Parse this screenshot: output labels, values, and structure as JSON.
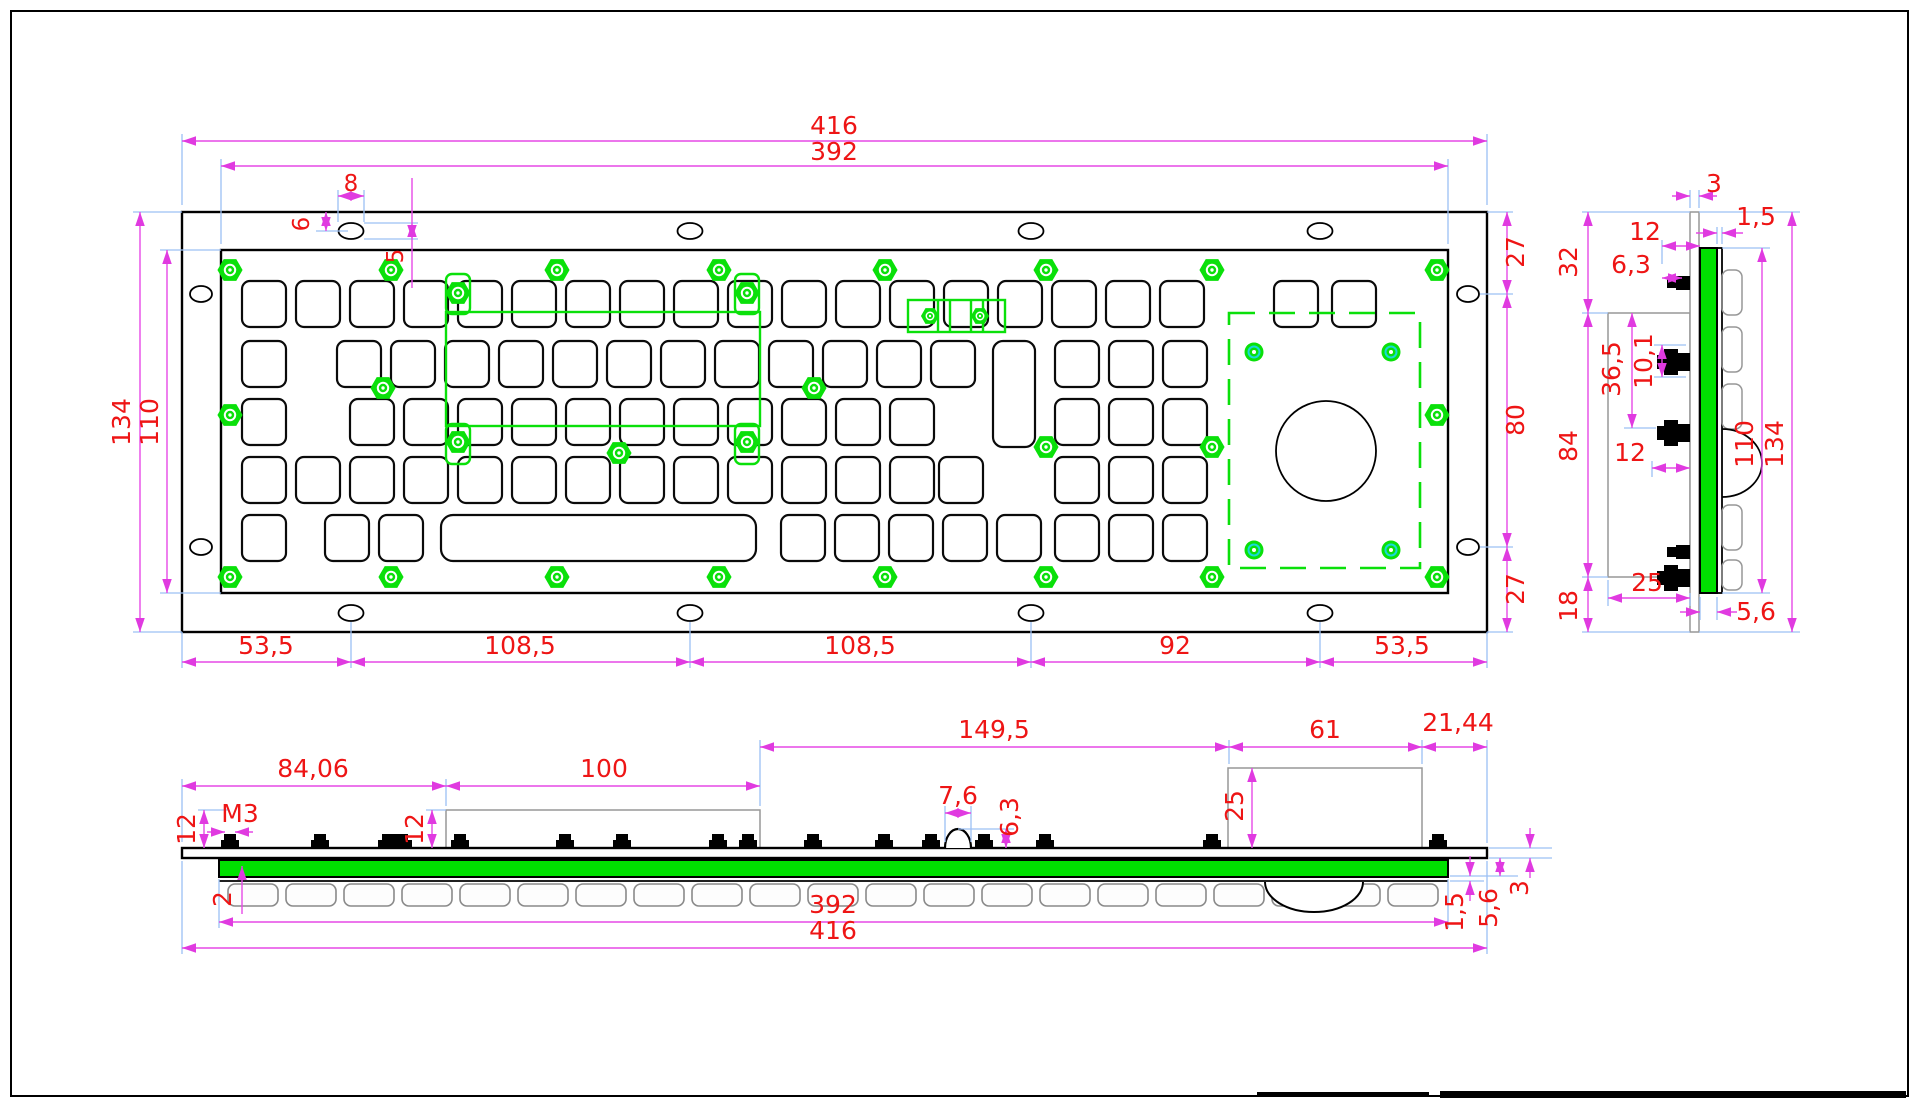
{
  "drawing": {
    "description": "CAD technical drawing of a panel-mount industrial metal keyboard with trackball: front view, side section view and bottom profile view with dimensions (mm)",
    "colors": {
      "dimension_text": "#ee1515",
      "dimension_line": "#e649e6",
      "extension_line": "#9cc0f4",
      "highlight_green": "#0ae00a",
      "panel_fill_green": "#00e000",
      "outline_black": "#000000",
      "outline_gray": "#979797"
    },
    "front": {
      "d416": "416",
      "d392": "392",
      "d8": "8",
      "d6": "6",
      "d5": "5",
      "d134": "134",
      "d110": "110",
      "d27_top": "27",
      "d80": "80",
      "d27_bottom": "27",
      "d53_5_left": "53,5",
      "d108_5_left": "108,5",
      "d108_5_right": "108,5",
      "d92": "92",
      "d53_5_right": "53,5"
    },
    "side": {
      "d3": "3",
      "d1_5": "1,5",
      "d12_top": "12",
      "d6_3": "6,3",
      "d32": "32",
      "d36_5": "36,5",
      "d10_1": "10,1",
      "d84": "84",
      "d12_mid": "12",
      "d110": "110",
      "d134": "134",
      "d25": "25",
      "d18": "18",
      "d5_6": "5,6"
    },
    "bottom": {
      "d84_06": "84,06",
      "d100": "100",
      "d149_5": "149,5",
      "d61": "61",
      "d21_44": "21,44",
      "d12_left": "12",
      "dM3": "M3",
      "d12_box": "12",
      "d7_6": "7,6",
      "d6_3": "6,3",
      "d25": "25",
      "d2": "2",
      "d392": "392",
      "d416": "416",
      "d1_5": "1,5",
      "d5_6": "5,6",
      "d3": "3"
    }
  }
}
